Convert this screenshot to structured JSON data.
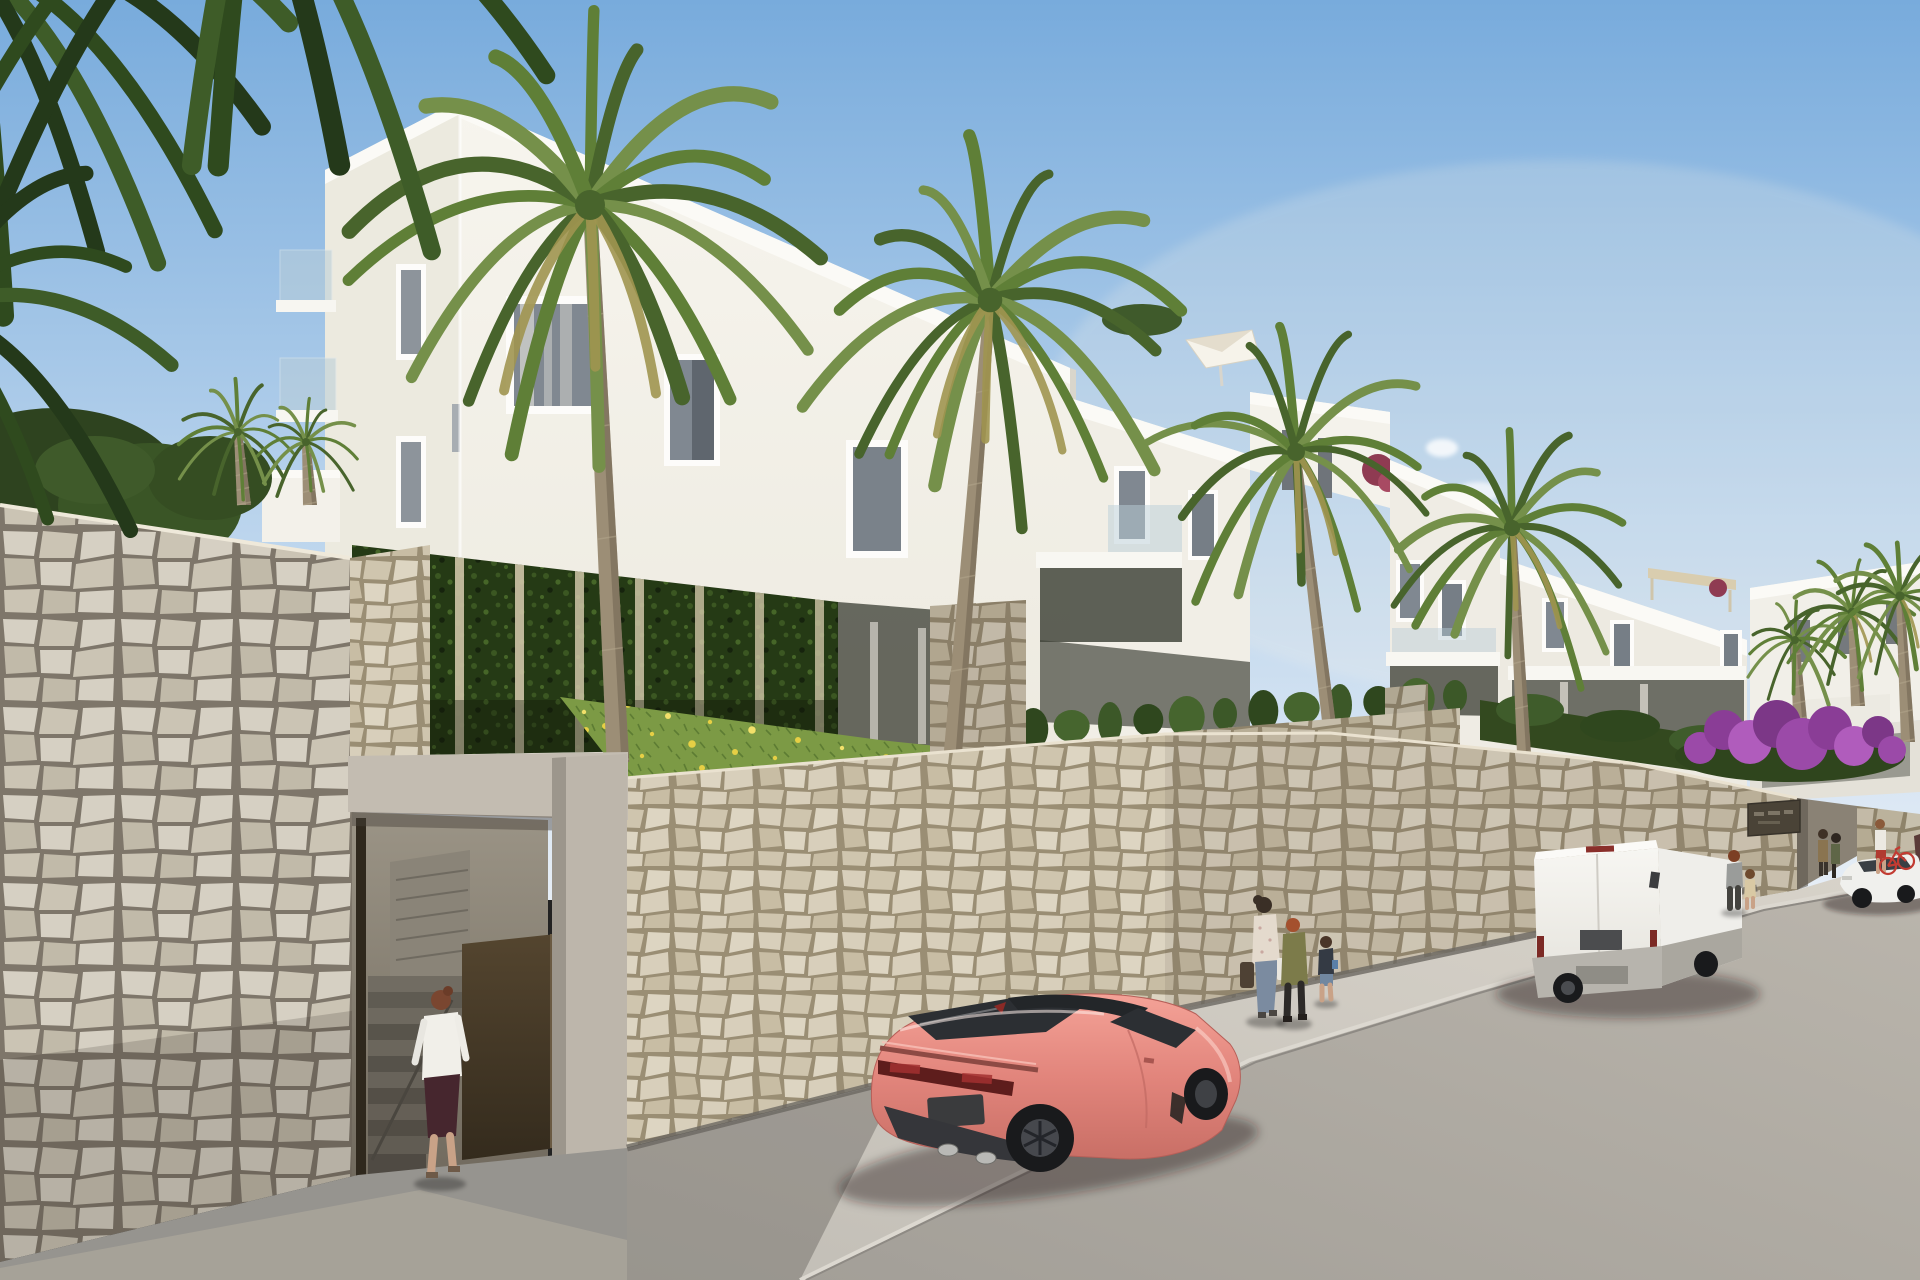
{
  "meta": {
    "description": "Photorealistic exterior render of a white new-build apartment complex on a hillside street with stone retaining walls, palm trees, pedestrians, a coral sports coupe, a white delivery van and a white sedan",
    "time_of_day": "sunny afternoon, sun from the right"
  },
  "palette": {
    "sky_top": "#78abdc",
    "sky_mid": "#b7d2ec",
    "sky_horizon": "#e7eef6",
    "haze": "#fdf6e8",
    "face_sun_1": "#f7f5ee",
    "face_sun_2": "#edeae0",
    "face_side": "#eceadf",
    "parapet": "#fbfaf6",
    "recess_dark": "#43463c",
    "window_glass": "#808891",
    "window_frame": "#fdfcfa",
    "glass_rail": "#b9cdd8",
    "stone_grout": "#9a8e74",
    "stone_a": "#d8cfbb",
    "stone_b": "#cfc5ae",
    "stone_c": "#c8bda4",
    "stone_d": "#ddd5c2",
    "stone_big_grout": "#7e766a",
    "stone_big_a": "#d6d0c3",
    "stone_big_b": "#cbc4b4",
    "stone_big_c": "#c1baa9",
    "concrete": "#c3bcb1",
    "concrete_pier": "#bdb6ab",
    "portal_top": "#9b9486",
    "portal_bottom": "#6d665a",
    "stair_dark": "#5a564d",
    "stair_light": "#6e695f",
    "door_top": "#54452f",
    "door_bottom": "#342b1d",
    "ivy": "#253a15",
    "ivy_leaf": "#3b5722",
    "hedge": "#33491f",
    "cypress_1": "#3c5828",
    "cypress_2": "#2f471e",
    "cypress_3": "#46652e",
    "grass": "#7c9a45",
    "grass_blade": "#5d7c33",
    "flower_1": "#e6cf45",
    "flower_2": "#f2e06a",
    "palm_1": "#5f7f37",
    "palm_2": "#48642c",
    "palm_3": "#75904a",
    "palm_dark_1": "#2f4a1e",
    "palm_dark_2": "#3e5c28",
    "palm_dark_3": "#24391a",
    "palm_dry": "#a09550",
    "trunk": "#9c8e76",
    "trunk_shade": "#6f6350",
    "road_near": "#a39f98",
    "road_far": "#bab5ac",
    "sidewalk": "#cdc9c1",
    "pave_shade": "#96948f",
    "curb": "#dcd8d0",
    "gutter": "#6b6862",
    "car_pink_1": "#f4a297",
    "car_pink_2": "#e2857c",
    "car_pink_3": "#c96f66",
    "car_glass": "#2c2f33",
    "tire": "#191a1c",
    "rim": "#46484d",
    "tail_red": "#5e1d1c",
    "plate": "#3a3b3d",
    "van_1": "#f7f6f2",
    "van_2": "#e4e2db",
    "van_bumper": "#b7b4ad",
    "sedan": "#f0f0ed",
    "boug_1": "#9b4aa8",
    "boug_2": "#8a3d96",
    "boug_3": "#b05cbc",
    "boug_4": "#7c3787",
    "sign_bg": "#4a4337",
    "skin": "#c9a287",
    "shadow": "rgba(35,30,28,0.42)"
  },
  "scene": {
    "vehicles": {
      "sports_car": {
        "type": "coupe rear three-quarter",
        "body_color": "#e8897f"
      },
      "van": {
        "type": "panel van rear view",
        "body_color": "#f4f3ef"
      },
      "sedan": {
        "type": "distant sedan",
        "body_color": "#f0f0ed"
      }
    },
    "people": [
      {
        "id": "woman-entering-gate",
        "blouse": "#f1efe9",
        "skirt": "#46262e",
        "hair": "#7a4630"
      },
      {
        "id": "woman-with-bags",
        "top": "#e4dacd",
        "jeans": "#7b8ba0"
      },
      {
        "id": "person-olive-jacket",
        "jacket": "#7c7b4a",
        "hair": "#a4502e"
      },
      {
        "id": "child-walking",
        "top": "#343a44",
        "shorts": "#7187a0"
      },
      {
        "id": "man-near-van",
        "shirt": "#9a9c9a"
      },
      {
        "id": "child-near-van",
        "outfit": "#d9c9a4"
      },
      {
        "id": "pair-at-entrance",
        "colors": [
          "#8a7450",
          "#5f6647"
        ]
      },
      {
        "id": "man-with-red-bike",
        "shirt": "#ece9e2",
        "shorts": "#b03a30",
        "bike": "#c23b32"
      }
    ],
    "palms": [
      {
        "cx": 590,
        "cy": 205,
        "r": 250,
        "bx": 618,
        "by": 762,
        "pal": "bright",
        "dry": 3,
        "n": 16
      },
      {
        "cx": 990,
        "cy": 300,
        "r": 205,
        "bx": 952,
        "by": 764,
        "pal": "bright",
        "dry": 3,
        "n": 15
      },
      {
        "cx": 1296,
        "cy": 452,
        "r": 150,
        "bx": 1332,
        "by": 748,
        "pal": "bright",
        "dry": 2,
        "n": 14
      },
      {
        "cx": 1512,
        "cy": 528,
        "r": 135,
        "bx": 1524,
        "by": 754,
        "pal": "bright",
        "dry": 2,
        "n": 14
      },
      {
        "cx": 238,
        "cy": 432,
        "r": 62,
        "bx": 244,
        "by": 505,
        "pal": "bright",
        "dry": 0,
        "n": 12
      },
      {
        "cx": 306,
        "cy": 442,
        "r": 55,
        "bx": 310,
        "by": 505,
        "pal": "bright",
        "dry": 0,
        "n": 12
      },
      {
        "cx": 1795,
        "cy": 640,
        "r": 62,
        "bx": 1800,
        "by": 720,
        "pal": "bright",
        "dry": 0,
        "n": 12
      },
      {
        "cx": 1852,
        "cy": 612,
        "r": 70,
        "bx": 1858,
        "by": 706,
        "pal": "bright",
        "dry": 1,
        "n": 13
      },
      {
        "cx": 1900,
        "cy": 596,
        "r": 78,
        "bx": 1908,
        "by": 742,
        "pal": "bright",
        "dry": 1,
        "n": 13
      }
    ],
    "fronds_foreground": [
      {
        "cx": -30,
        "cy": -40,
        "r": 360,
        "pal": "dark",
        "n": 18
      },
      {
        "cx": 250,
        "cy": -140,
        "r": 340,
        "pal": "dark",
        "n": 18
      },
      {
        "cx": -70,
        "cy": 310,
        "r": 235,
        "pal": "dark",
        "n": 15
      }
    ],
    "cypress_row": {
      "x1": 995,
      "y1": 742,
      "x2": 1455,
      "y2": 706,
      "count": 13
    },
    "flowers": [
      [
        584,
        712
      ],
      [
        605,
        726
      ],
      [
        628,
        704
      ],
      [
        652,
        734
      ],
      [
        668,
        716
      ],
      [
        692,
        744
      ],
      [
        710,
        722
      ],
      [
        735,
        752
      ],
      [
        752,
        730
      ],
      [
        775,
        758
      ],
      [
        798,
        740
      ],
      [
        820,
        764
      ],
      [
        842,
        748
      ],
      [
        864,
        772
      ],
      [
        886,
        758
      ],
      [
        906,
        782
      ],
      [
        928,
        768
      ],
      [
        948,
        790
      ],
      [
        642,
        756
      ],
      [
        702,
        768
      ],
      [
        762,
        776
      ],
      [
        822,
        786
      ],
      [
        878,
        794
      ],
      [
        930,
        800
      ],
      [
        614,
        744
      ],
      [
        586,
        730
      ]
    ]
  }
}
